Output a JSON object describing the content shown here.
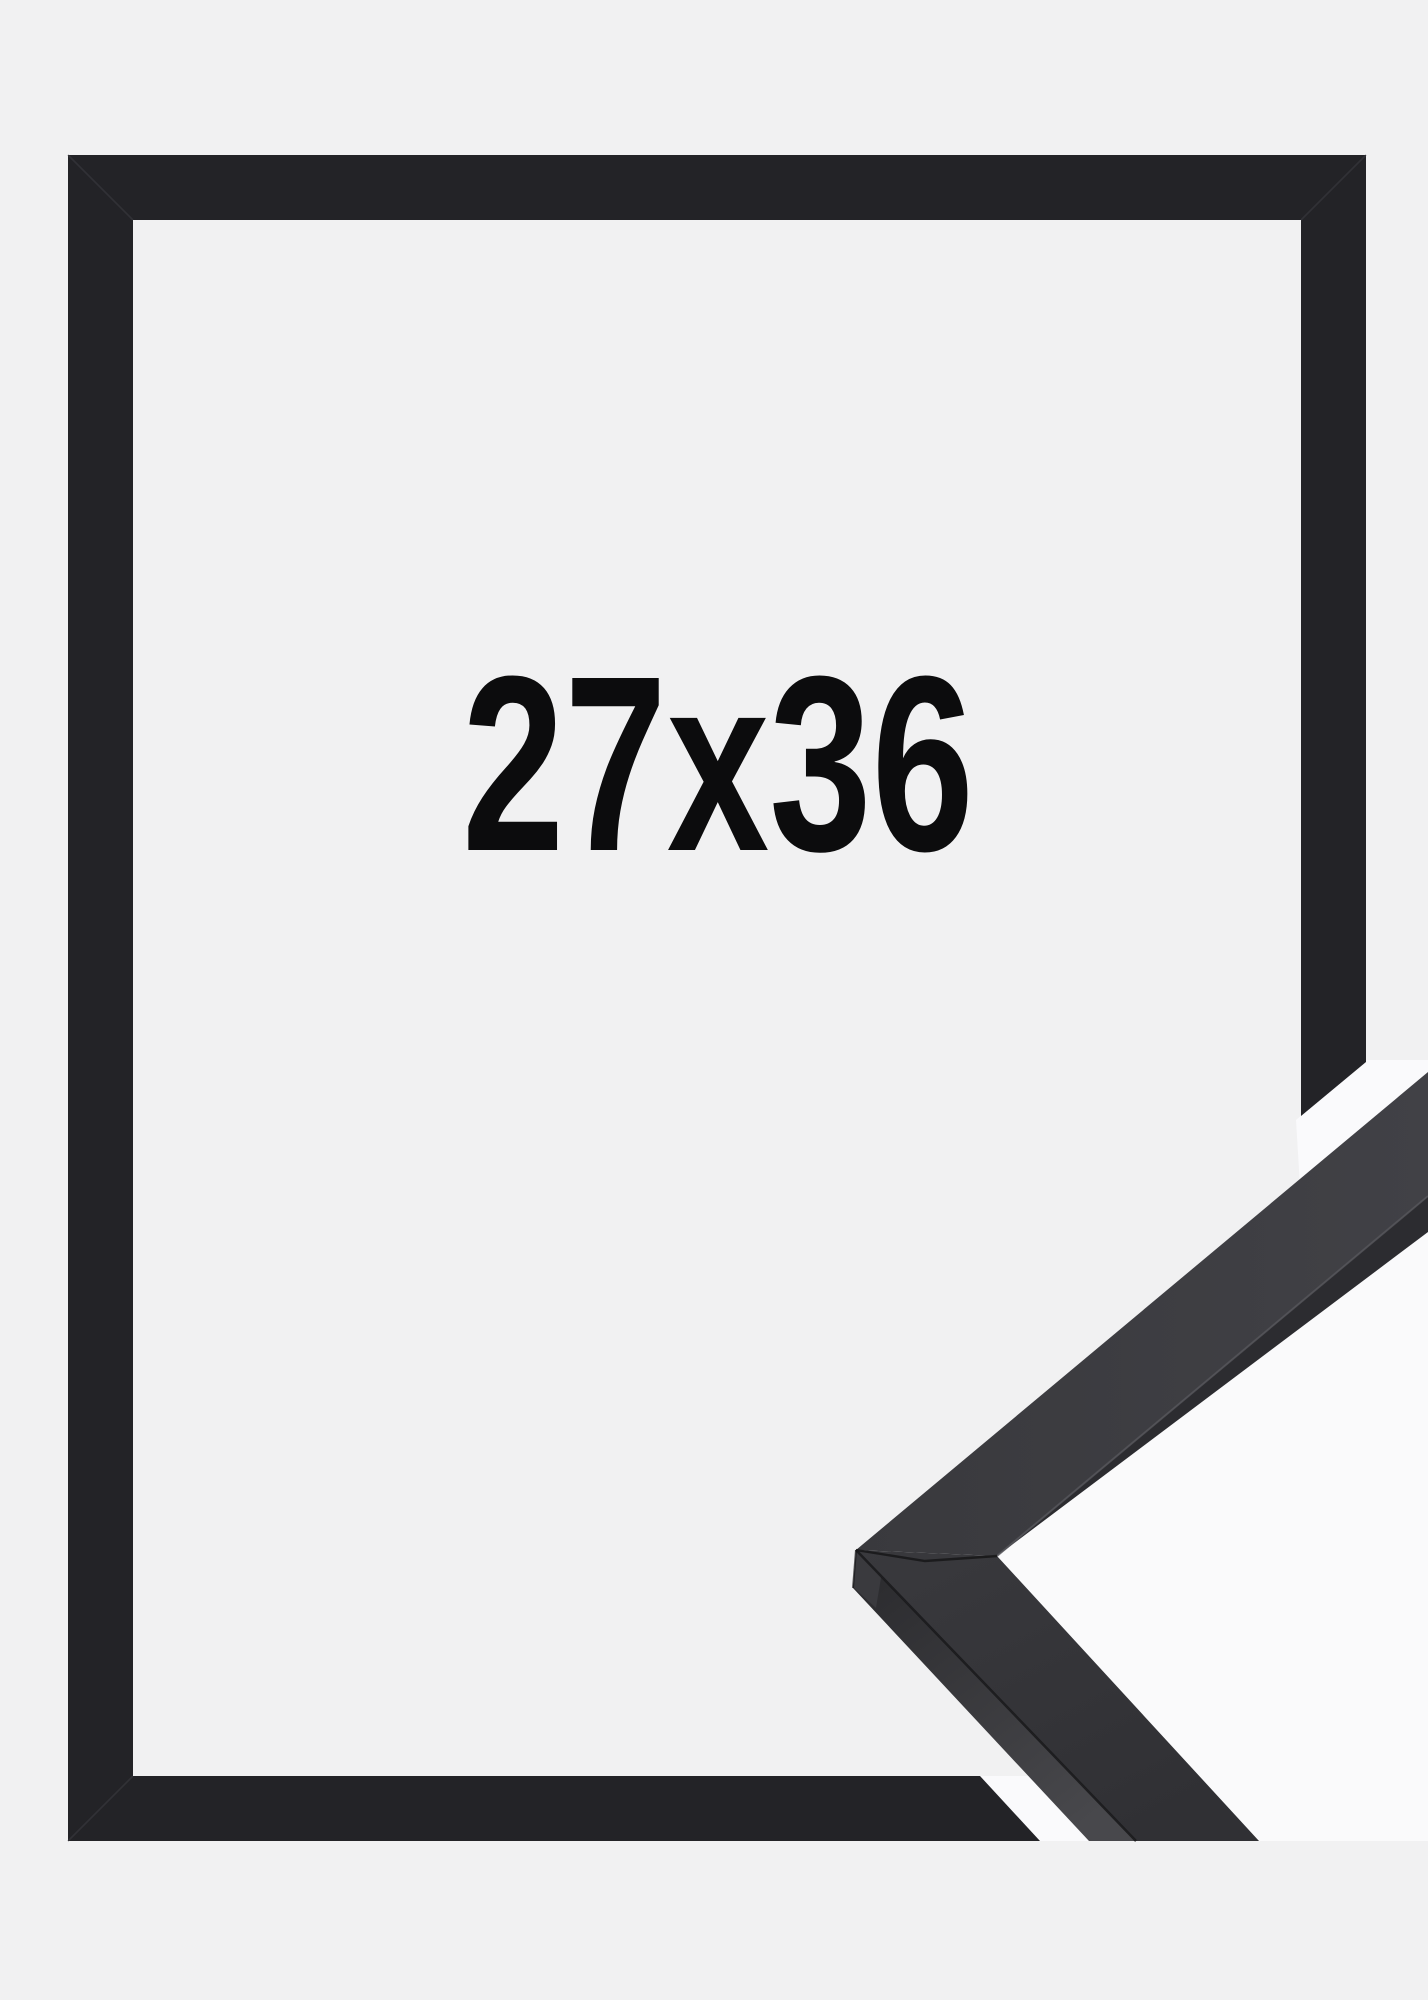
{
  "product_photo": {
    "size_label": "27x36"
  },
  "colors": {
    "background": "#f1f1f2",
    "frame": "#232327",
    "frame_seam": "#3e3e44",
    "sample_top": "#39393d",
    "sample_top_light": "#414146",
    "sample_top_dark": "#303034",
    "sample_side": "#2c2c30",
    "sample_side_tip": "#29292c",
    "sample_side_end": "#48484c",
    "sample_tip_face": "#3a3a3e",
    "crease_dark": "#1a1a1c",
    "crease_light": "#56565b",
    "miter_seam": "#161618",
    "gap_light": "#fbfbfd",
    "text": "#0c0c0d"
  }
}
